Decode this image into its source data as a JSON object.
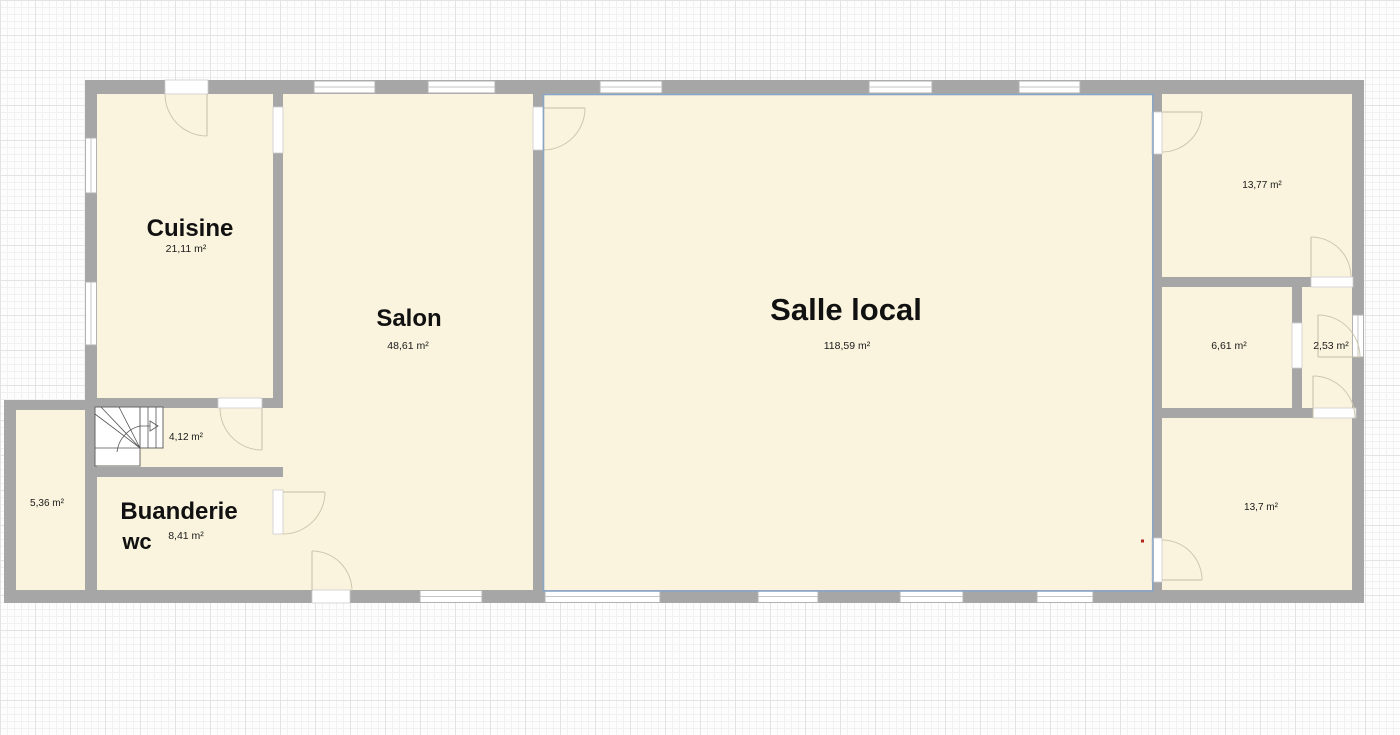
{
  "app": {
    "view": "floor-plan-canvas"
  },
  "colors": {
    "wall": "#a6a6a6",
    "room_fill": "#faf4de",
    "selection_outline": "#8aa5c6",
    "door_arc": "#cfc6ad",
    "red_marker": "#b3261e",
    "background": "#fdfdfd"
  },
  "rooms": [
    {
      "label": "Cuisine",
      "area": "21,11 m²"
    },
    {
      "label": "Salon",
      "area": "48,61 m²"
    },
    {
      "label": "Salle local",
      "area": "118,59 m²",
      "selected": true
    },
    {
      "label": "Buanderie",
      "sublabel": "wc",
      "area": "8,41 m²"
    },
    {
      "label": "",
      "area": "5,36 m²"
    },
    {
      "label": "",
      "area": "4,12 m²"
    },
    {
      "label": "",
      "area": "13,77 m²"
    },
    {
      "label": "",
      "area": "6,61 m²"
    },
    {
      "label": "",
      "area": "2,53 m²"
    },
    {
      "label": "",
      "area": "13,7 m²"
    }
  ]
}
